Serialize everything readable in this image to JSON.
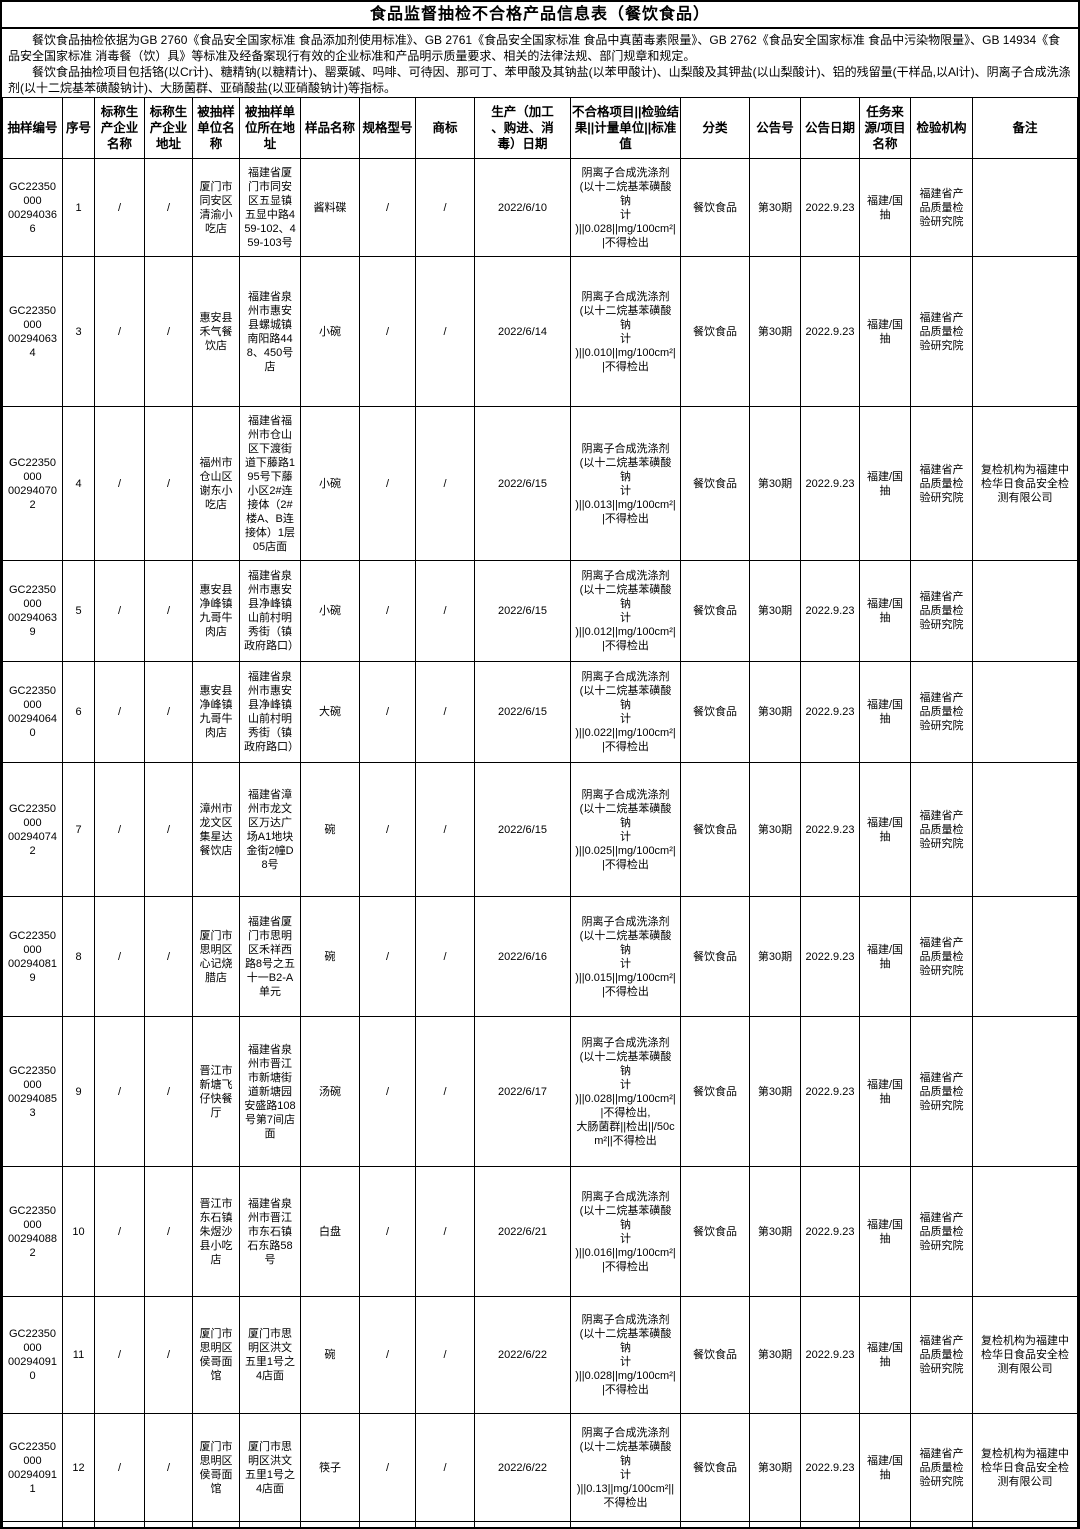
{
  "title": "食品监督抽检不合格产品信息表（餐饮食品）",
  "intro": {
    "p1": "餐饮食品抽检依据为GB 2760《食品安全国家标准 食品添加剂使用标准》、GB 2761《食品安全国家标准 食品中真菌毒素限量》、GB 2762《食品安全国家标准 食品中污染物限量》、GB 14934《食品安全国家标准 消毒餐（饮）具》等标准及经备案现行有效的企业标准和产品明示质量要求、相关的法律法规、部门规章和规定。",
    "p2": "餐饮食品抽检项目包括铬(以Cr计)、糖精钠(以糖精计)、罂粟碱、吗啡、可待因、那可丁、苯甲酸及其钠盐(以苯甲酸计)、山梨酸及其钾盐(以山梨酸计)、铝的残留量(干样品,以Al计)、阴离子合成洗涤剂(以十二烷基苯磺酸钠计)、大肠菌群、亚硝酸盐(以亚硝酸钠计)等指标。"
  },
  "table": {
    "headers": [
      "抽样编号",
      "序号",
      "标称生产企业名称",
      "标称生产企业地址",
      "被抽样单位名称",
      "被抽样单位所在地址",
      "样品名称",
      "规格型号",
      "商标",
      "生产（加工\n、购进、消\n毒）日期",
      "不合格项目||检验结果||计量单位||标准值",
      "分类",
      "公告号",
      "公告日期",
      "任务来源/项目名称",
      "检验机构",
      "备注"
    ],
    "rows": [
      [
        "GC22350000\n002940366",
        "1",
        "/",
        "/",
        "厦门市同安区清渝小吃店",
        "福建省厦门市同安区五显镇五显中路459-102、459-103号",
        "酱料碟",
        "/",
        "/",
        "2022/6/10",
        "阴离子合成洗涤剂\n(以十二烷基苯磺酸钠\n计\n)||0.028||mg/100cm²||不得检出",
        "餐饮食品",
        "第30期",
        "2022.9.23",
        "福建/国抽",
        "福建省产品质量检验研究院",
        ""
      ],
      [
        "GC22350000\n002940634",
        "3",
        "/",
        "/",
        "惠安县禾气餐饮店",
        "福建省泉州市惠安县螺城镇南阳路448、450号店",
        "小碗",
        "/",
        "/",
        "2022/6/14",
        "阴离子合成洗涤剂\n(以十二烷基苯磺酸钠\n计\n)||0.010||mg/100cm²||不得检出",
        "餐饮食品",
        "第30期",
        "2022.9.23",
        "福建/国抽",
        "福建省产品质量检验研究院",
        ""
      ],
      [
        "GC22350000\n002940702",
        "4",
        "/",
        "/",
        "福州市仓山区谢东小吃店",
        "福建省福州市仓山区下渡街道下藤路195号下藤小区2#连接体（2#楼A、B连接体）1层05店面",
        "小碗",
        "/",
        "/",
        "2022/6/15",
        "阴离子合成洗涤剂\n(以十二烷基苯磺酸钠\n计\n)||0.013||mg/100cm²||不得检出",
        "餐饮食品",
        "第30期",
        "2022.9.23",
        "福建/国抽",
        "福建省产品质量检验研究院",
        "复检机构为福建中检华日食品安全检测有限公司"
      ],
      [
        "GC22350000\n002940639",
        "5",
        "/",
        "/",
        "惠安县净峰镇九哥牛肉店",
        "福建省泉州市惠安县净峰镇山前村明秀街（镇政府路口）",
        "小碗",
        "/",
        "/",
        "2022/6/15",
        "阴离子合成洗涤剂\n(以十二烷基苯磺酸钠\n计\n)||0.012||mg/100cm²||不得检出",
        "餐饮食品",
        "第30期",
        "2022.9.23",
        "福建/国抽",
        "福建省产品质量检验研究院",
        ""
      ],
      [
        "GC22350000\n002940640",
        "6",
        "/",
        "/",
        "惠安县净峰镇九哥牛肉店",
        "福建省泉州市惠安县净峰镇山前村明秀街（镇政府路口）",
        "大碗",
        "/",
        "/",
        "2022/6/15",
        "阴离子合成洗涤剂\n(以十二烷基苯磺酸钠\n计\n)||0.022||mg/100cm²||不得检出",
        "餐饮食品",
        "第30期",
        "2022.9.23",
        "福建/国抽",
        "福建省产品质量检验研究院",
        ""
      ],
      [
        "GC22350000\n002940742",
        "7",
        "/",
        "/",
        "漳州市龙文区集星达餐饮店",
        "福建省漳州市龙文区万达广场A1地块金街2幢D8号",
        "碗",
        "/",
        "/",
        "2022/6/15",
        "阴离子合成洗涤剂\n(以十二烷基苯磺酸钠\n计\n)||0.025||mg/100cm²||不得检出",
        "餐饮食品",
        "第30期",
        "2022.9.23",
        "福建/国抽",
        "福建省产品质量检验研究院",
        ""
      ],
      [
        "GC22350000\n002940819",
        "8",
        "/",
        "/",
        "厦门市思明区心记烧腊店",
        "福建省厦门市思明区禾祥西路8号之五十一B2-A单元",
        "碗",
        "/",
        "/",
        "2022/6/16",
        "阴离子合成洗涤剂\n(以十二烷基苯磺酸钠\n计\n)||0.015||mg/100cm²||不得检出",
        "餐饮食品",
        "第30期",
        "2022.9.23",
        "福建/国抽",
        "福建省产品质量检验研究院",
        ""
      ],
      [
        "GC22350000\n002940853",
        "9",
        "/",
        "/",
        "晋江市新塘飞仔快餐厅",
        "福建省泉州市晋江市新塘街道新塘园安盛路108号第7间店面",
        "汤碗",
        "/",
        "/",
        "2022/6/17",
        "阴离子合成洗涤剂\n(以十二烷基苯磺酸钠\n计\n)||0.028||mg/100cm²||不得检出,\n大肠菌群||检出||/50cm²||不得检出",
        "餐饮食品",
        "第30期",
        "2022.9.23",
        "福建/国抽",
        "福建省产品质量检验研究院",
        ""
      ],
      [
        "GC22350000\n002940882",
        "10",
        "/",
        "/",
        "晋江市东石镇朱煜沙县小吃店",
        "福建省泉州市晋江市东石镇石东路58号",
        "白盘",
        "/",
        "/",
        "2022/6/21",
        "阴离子合成洗涤剂\n(以十二烷基苯磺酸钠\n计\n)||0.016||mg/100cm²||不得检出",
        "餐饮食品",
        "第30期",
        "2022.9.23",
        "福建/国抽",
        "福建省产品质量检验研究院",
        ""
      ],
      [
        "GC22350000\n002940910",
        "11",
        "/",
        "/",
        "厦门市思明区侯哥面馆",
        "厦门市思明区洪文五里1号之4店面",
        "碗",
        "/",
        "/",
        "2022/6/22",
        "阴离子合成洗涤剂\n(以十二烷基苯磺酸钠\n计\n)||0.028||mg/100cm²||不得检出",
        "餐饮食品",
        "第30期",
        "2022.9.23",
        "福建/国抽",
        "福建省产品质量检验研究院",
        "复检机构为福建中检华日食品安全检测有限公司"
      ],
      [
        "GC22350000\n002940911",
        "12",
        "/",
        "/",
        "厦门市思明区侯哥面馆",
        "厦门市思明区洪文五里1号之4店面",
        "筷子",
        "/",
        "/",
        "2022/6/22",
        "阴离子合成洗涤剂\n(以十二烷基苯磺酸钠\n计\n)||0.13||mg/100cm²||不得检出",
        "餐饮食品",
        "第30期",
        "2022.9.23",
        "福建/国抽",
        "福建省产品质量检验研究院",
        "复检机构为福建中检华日食品安全检测有限公司"
      ]
    ]
  }
}
